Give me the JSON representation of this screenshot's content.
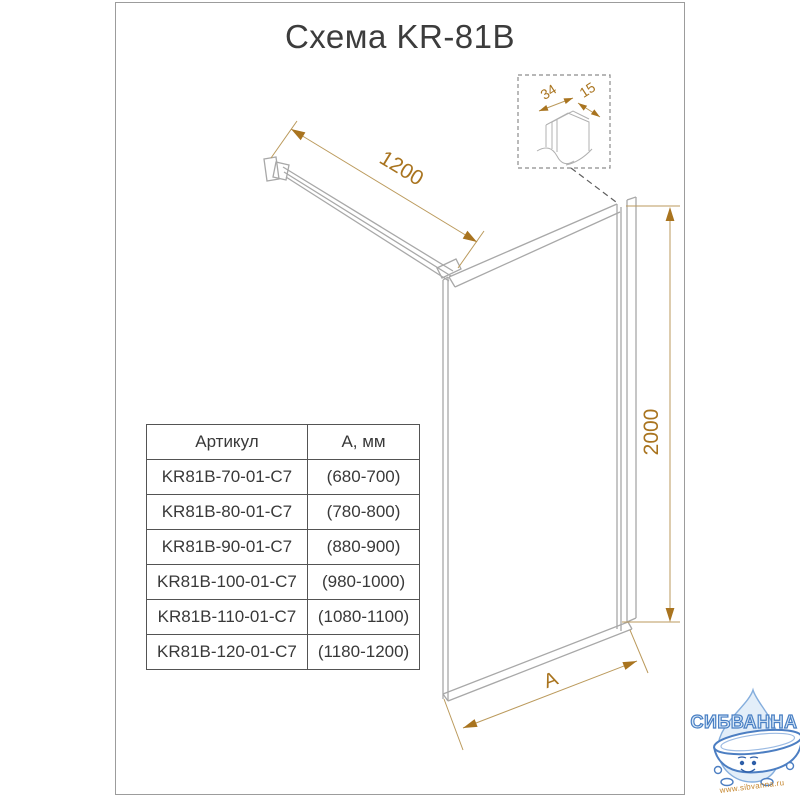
{
  "title": "Схема KR-81B",
  "dimensions": {
    "width": "1200",
    "height": "2000",
    "bottom": "A"
  },
  "detail": {
    "thickness": "34",
    "depth": "15"
  },
  "table": {
    "headers": [
      "Артикул",
      "А, мм"
    ],
    "rows": [
      {
        "article": "KR81B-70-01-C7",
        "a_mm": "(680-700)"
      },
      {
        "article": "KR81B-80-01-C7",
        "a_mm": "(780-800)"
      },
      {
        "article": "KR81B-90-01-C7",
        "a_mm": "(880-900)"
      },
      {
        "article": "KR81B-100-01-C7",
        "a_mm": "(980-1000)"
      },
      {
        "article": "KR81B-110-01-C7",
        "a_mm": "(1080-1100)"
      },
      {
        "article": "KR81B-120-01-C7",
        "a_mm": "(1180-1200)"
      }
    ]
  },
  "logo": {
    "brand": "СИБВАННА",
    "url": "www.sibvanna.ru"
  },
  "colors": {
    "accent_gold": "#a9741f",
    "drawing_gray": "#a8a8a8",
    "text_dark": "#3c3c3c",
    "logo_blue": "#4a80c4",
    "logo_fill": "#d9e8f7",
    "url_orange": "#c5862e"
  }
}
